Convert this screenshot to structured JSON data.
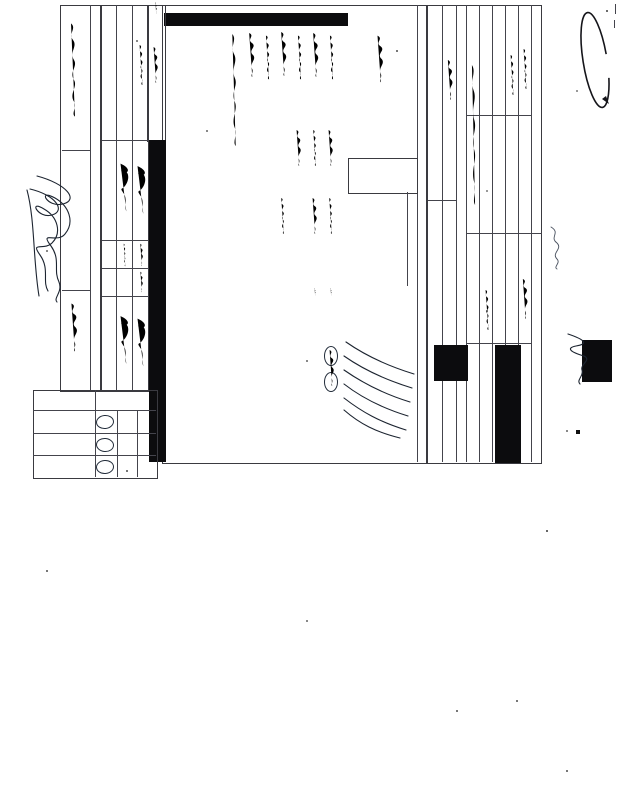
{
  "document": {
    "title": "CHAIN-OF-CUSTODY / Analytical Request Document",
    "subtitle": "The Chain-of-Custody is a LEGAL DOCUMENT. All relevant fields must be completed accurately.",
    "page_label": "10 of 10",
    "coc_number_handwritten": "35212",
    "form_number": "F-ALL-Q-020rev.08, 12-Oct-2007",
    "logo": {
      "brand": "PaceAnalytical",
      "tagline": "www.pacelabs.com"
    }
  },
  "sections": {
    "a": {
      "label": "Section A",
      "sublabel": "Required Client Information:",
      "fields": [
        "Company:",
        "Address:",
        "Email To:",
        "Phone:",
        "Fax:",
        "Requested Due Date/TAT:"
      ]
    },
    "b": {
      "label": "Section B",
      "sublabel": "Required Project Information:",
      "fields": [
        "Report To:",
        "Copy To:",
        "Purchase Order No.:",
        "Project Name:",
        "Project Number:"
      ]
    },
    "c": {
      "label": "Section C",
      "sublabel": "Invoice Information:",
      "fields": [
        "Attention:",
        "Company Name:",
        "Pace Quote Reference:",
        "Pace Project Manager:"
      ]
    },
    "d": {
      "label": "Section D",
      "sublabel": "Required Sample Information"
    }
  },
  "sample_table": {
    "item_header": "ITEM #",
    "sample_id_header": "SAMPLE ID",
    "sample_id_note1": "(A-Z, 0-9 / ,-)",
    "sample_id_note2": "Sample IDs MUST BE UNIQUE",
    "matrix_header": "MATRIX CODE",
    "type_header": "SAMPLE TYPE (G=GRAB C=COMP)",
    "collected_header": "COLLECTED",
    "date_label": "DATE",
    "time_label": "TIME",
    "containers_header": "# OF CONTAINERS",
    "preservatives": [
      "Unpreserved",
      "H2SO4",
      "HNO3",
      "HCl",
      "NaOH",
      "Other"
    ],
    "matrix_codes": [
      [
        "DRINKING WATER",
        "DW"
      ],
      [
        "WATER",
        "WT"
      ],
      [
        "WASTE WATER",
        "WW"
      ],
      [
        "PRODUCT",
        "P"
      ],
      [
        "SOIL/SOLID",
        "SL"
      ],
      [
        "OIL",
        "OL"
      ],
      [
        "WIPE",
        "WP"
      ],
      [
        "AIR",
        "AR"
      ],
      [
        "TISSUE",
        "TS"
      ],
      [
        "OTHER",
        "OT"
      ]
    ],
    "lab_id_header": "Pace Project No./ Lab I.D.",
    "row_count": 11
  },
  "signature_block": {
    "comments_label": "ADDITIONAL COMMENTS",
    "header_labels": [
      "RELINQUISHED BY / AFFILIATION",
      "DATE",
      "TIME",
      "ACCEPTED BY / AFFILIATION",
      "DATE",
      "TIME",
      "SAMPLE CONDITIONS"
    ]
  },
  "sampler_block": {
    "header": "SAMPLER NAME AND SIGNATURE",
    "fields": [
      "PRINT Name of SAMPLER:",
      "SIGNATURE of SAMPLER:",
      "DATE Signed (MM/DD/YY):"
    ]
  },
  "conditions_table": {
    "rows": [
      "Temp in °C",
      "Received on Ice (Y/N)",
      "Custody Sealed Cooler (Y/N)",
      "Samples Intact (Y/N)"
    ],
    "options": [
      "YES",
      "NO",
      "N/A"
    ],
    "temp_value": "1.5"
  }
}
